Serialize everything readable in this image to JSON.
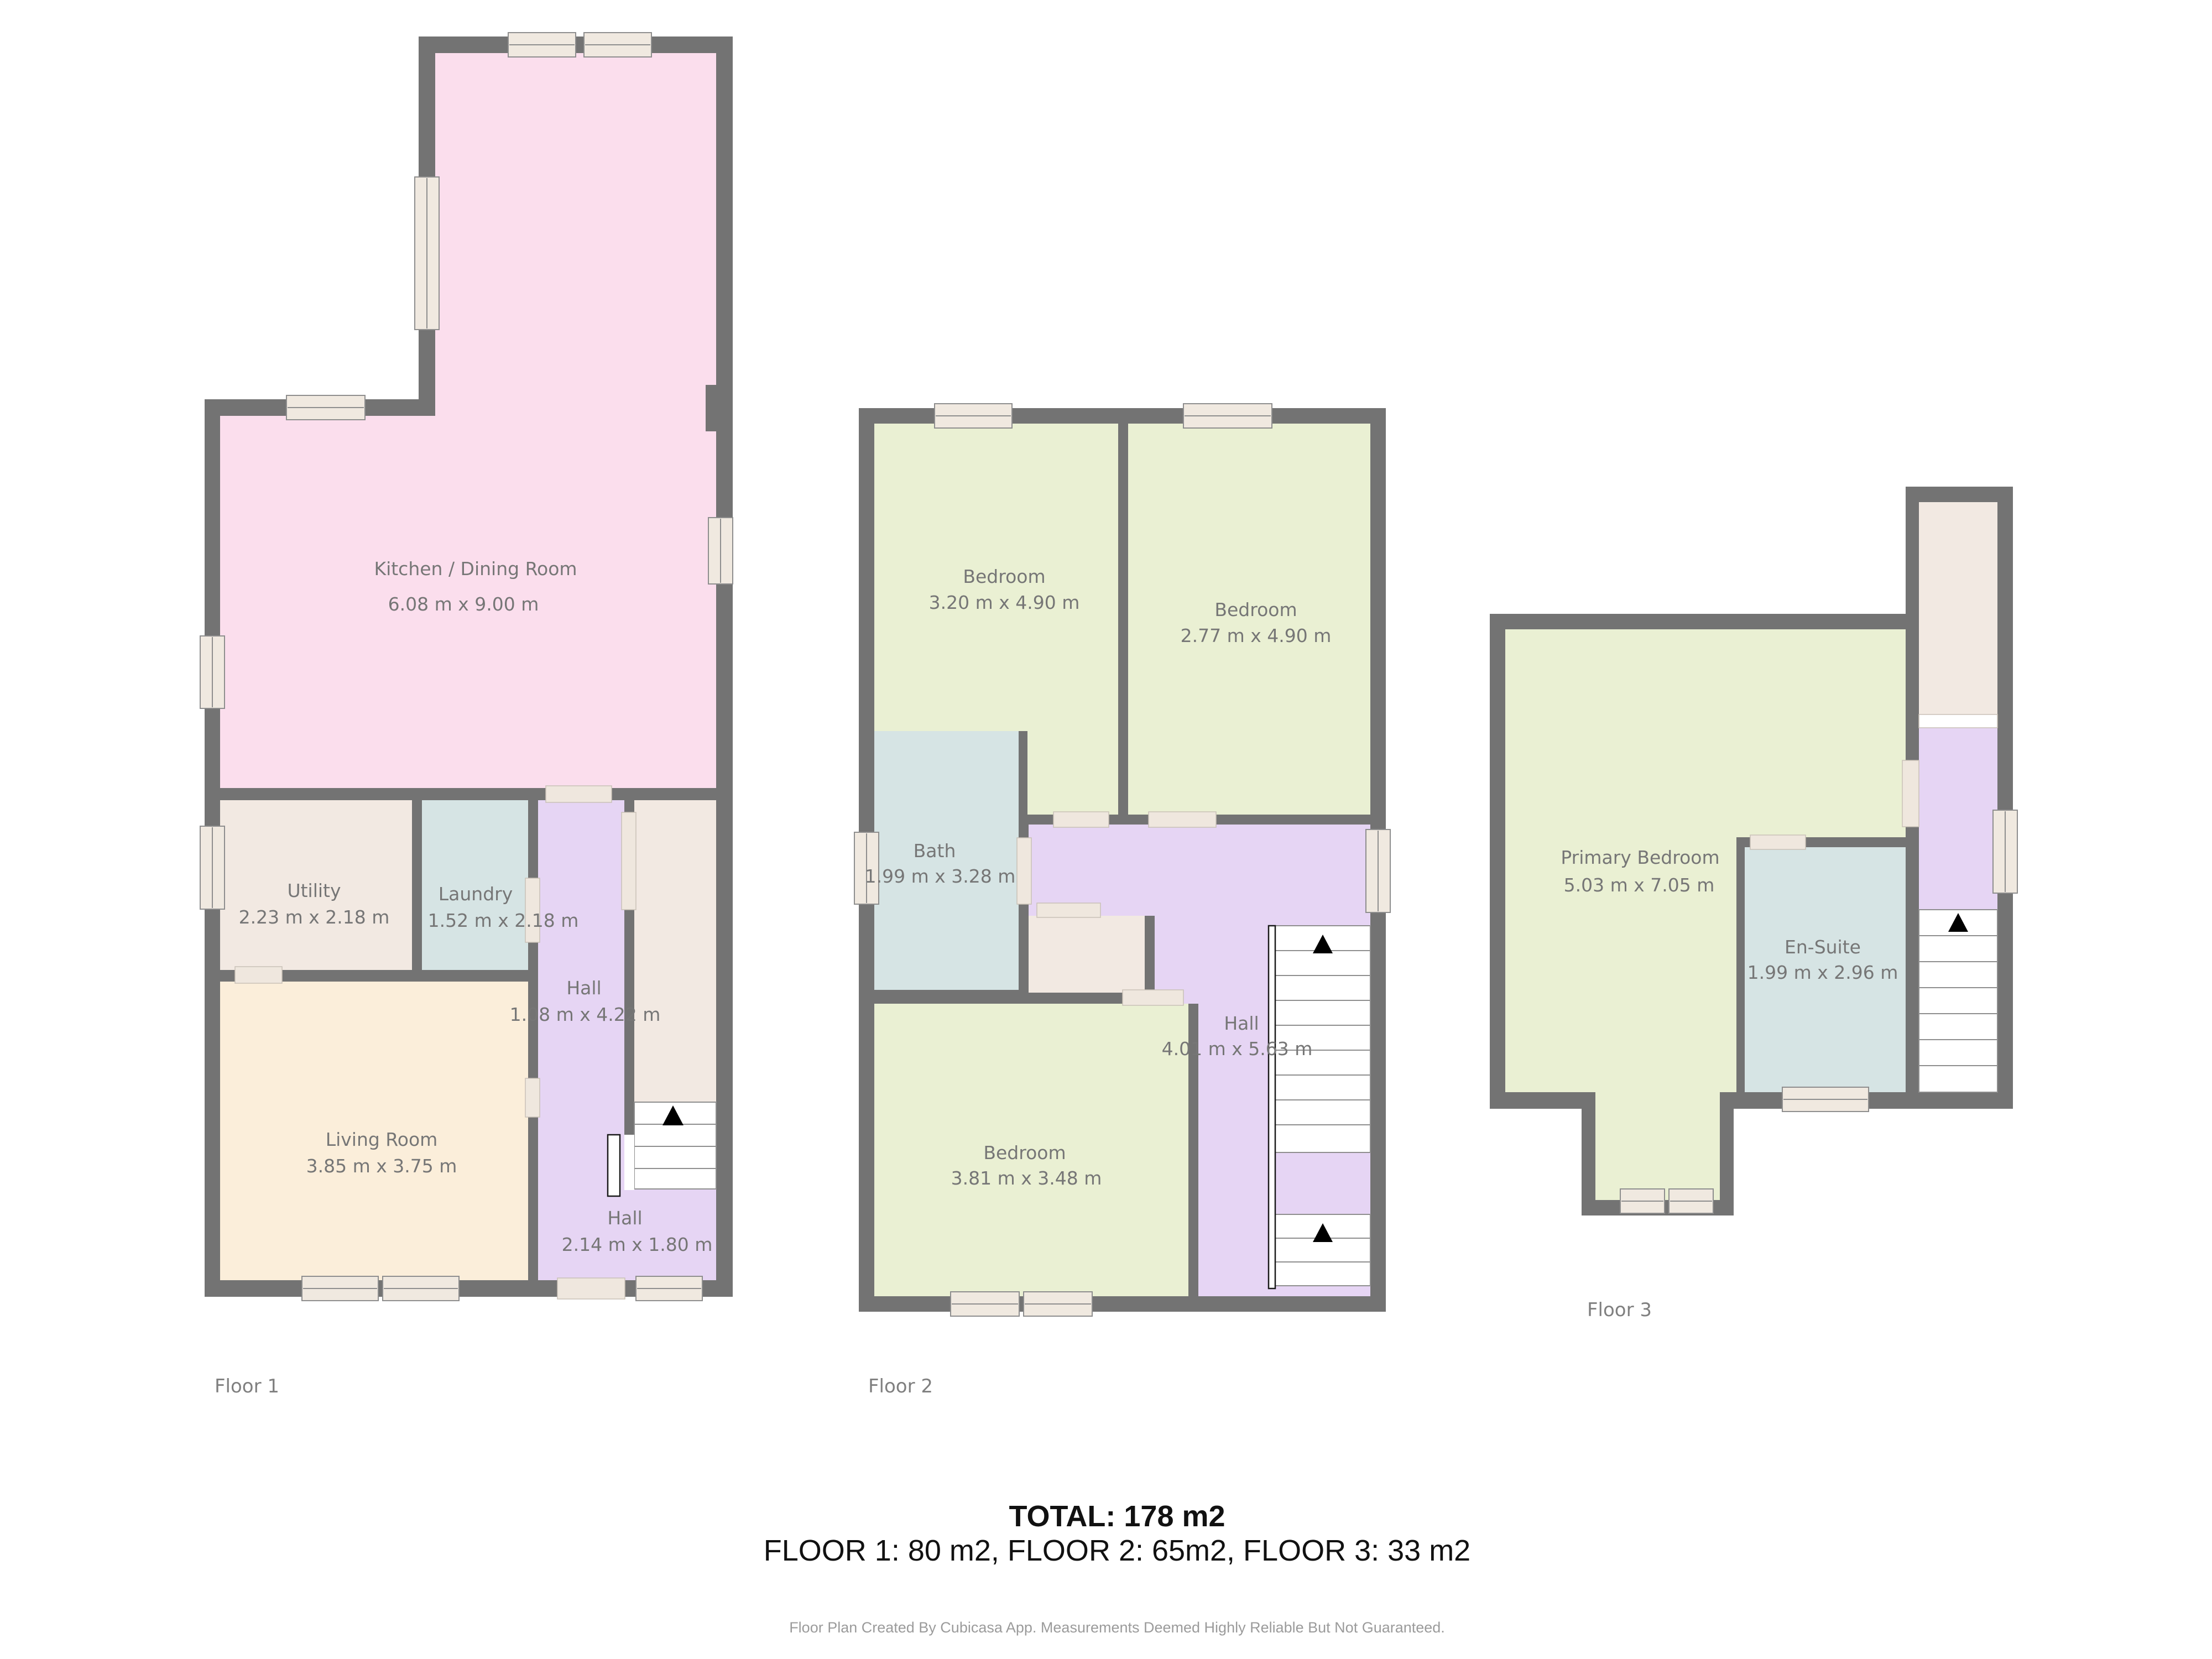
{
  "colors": {
    "background": "#ffffff",
    "wall": "#737373",
    "kitchen": "#fbdeed",
    "bedroom": "#eaf0d3",
    "bath": "#d6e4e4",
    "hall": "#e6d5f4",
    "living": "#fbeeda",
    "storage": "#f2e9e2",
    "window_fill": "#f0e9e0",
    "door_fill": "#efe7de",
    "stairs_fill": "#ffffff",
    "arrow": "#000000",
    "room_label": "#767676",
    "floor_label": "#7f7f7f",
    "summary_text": "#111111",
    "footer_text": "#9b9b9b"
  },
  "floors": [
    {
      "label": "Floor 1",
      "rooms": [
        {
          "name": "Kitchen / Dining Room",
          "dims": "6.08 m x 9.00 m"
        },
        {
          "name": "Utility",
          "dims": "2.23 m x 2.18 m"
        },
        {
          "name": "Laundry",
          "dims": "1.52 m x 2.18 m"
        },
        {
          "name": "Hall",
          "dims": "1.08 m x 4.22 m"
        },
        {
          "name": "Living Room",
          "dims": "3.85 m x 3.75 m"
        },
        {
          "name": "Hall",
          "dims": "2.14 m x 1.80 m"
        }
      ]
    },
    {
      "label": "Floor 2",
      "rooms": [
        {
          "name": "Bedroom",
          "dims": "3.20 m x 4.90 m"
        },
        {
          "name": "Bedroom",
          "dims": "2.77 m x 4.90 m"
        },
        {
          "name": "Bath",
          "dims": "1.99 m x 3.28 m"
        },
        {
          "name": "Hall",
          "dims": "4.01 m x 5.63 m"
        },
        {
          "name": "Bedroom",
          "dims": "3.81 m x 3.48 m"
        }
      ]
    },
    {
      "label": "Floor 3",
      "rooms": [
        {
          "name": "Primary Bedroom",
          "dims": "5.03 m x 7.05 m"
        },
        {
          "name": "En-Suite",
          "dims": "1.99 m x 2.96 m"
        }
      ]
    }
  ],
  "summary": {
    "total": "TOTAL: 178 m2",
    "floor_breakdown": "FLOOR 1: 80 m2, FLOOR 2: 65m2, FLOOR 3: 33 m2"
  },
  "footer": "Floor Plan Created By Cubicasa App. Measurements Deemed Highly Reliable But Not Guaranteed."
}
